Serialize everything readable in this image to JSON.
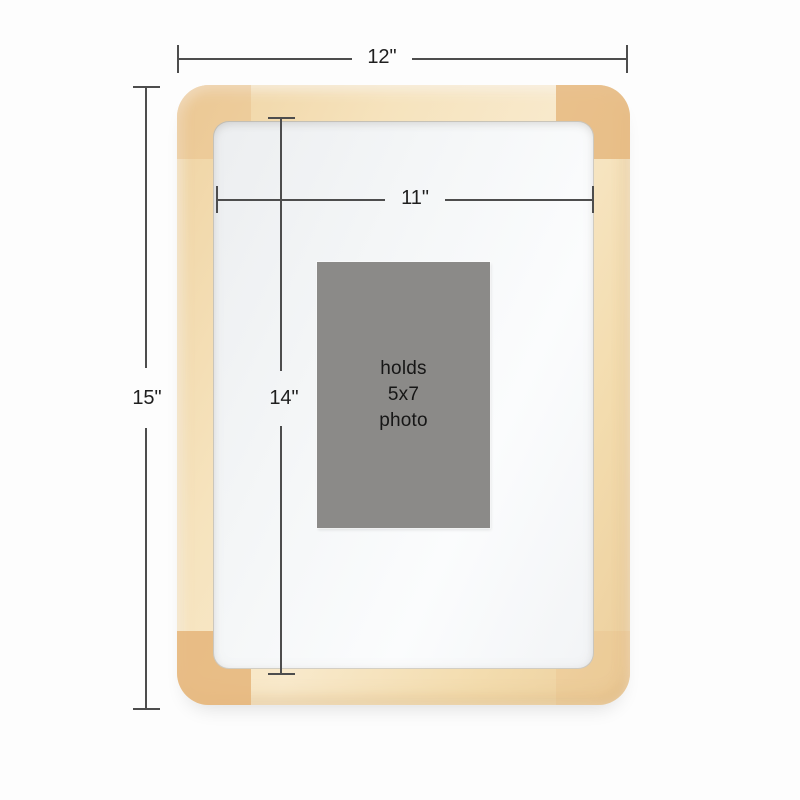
{
  "product": {
    "kind": "rounded natural wood picture frame",
    "placeholder": {
      "line1": "holds",
      "line2": "5x7",
      "line3": "photo"
    }
  },
  "dims": {
    "outer_width": {
      "label": "12\""
    },
    "outer_height": {
      "label": "15\""
    },
    "inner_width": {
      "label": "11\""
    },
    "inner_height": {
      "label": "14\""
    }
  },
  "colors": {
    "background": "#fdfdfd",
    "wood_light": "#f8e9cb",
    "wood_mid": "#f3dcae",
    "wood_corner": "#e5b57a",
    "mat": "#f5f7f8",
    "photo_gray": "#8b8a88",
    "dimension_line": "#4d4d4d",
    "text": "#1f1f1f"
  }
}
